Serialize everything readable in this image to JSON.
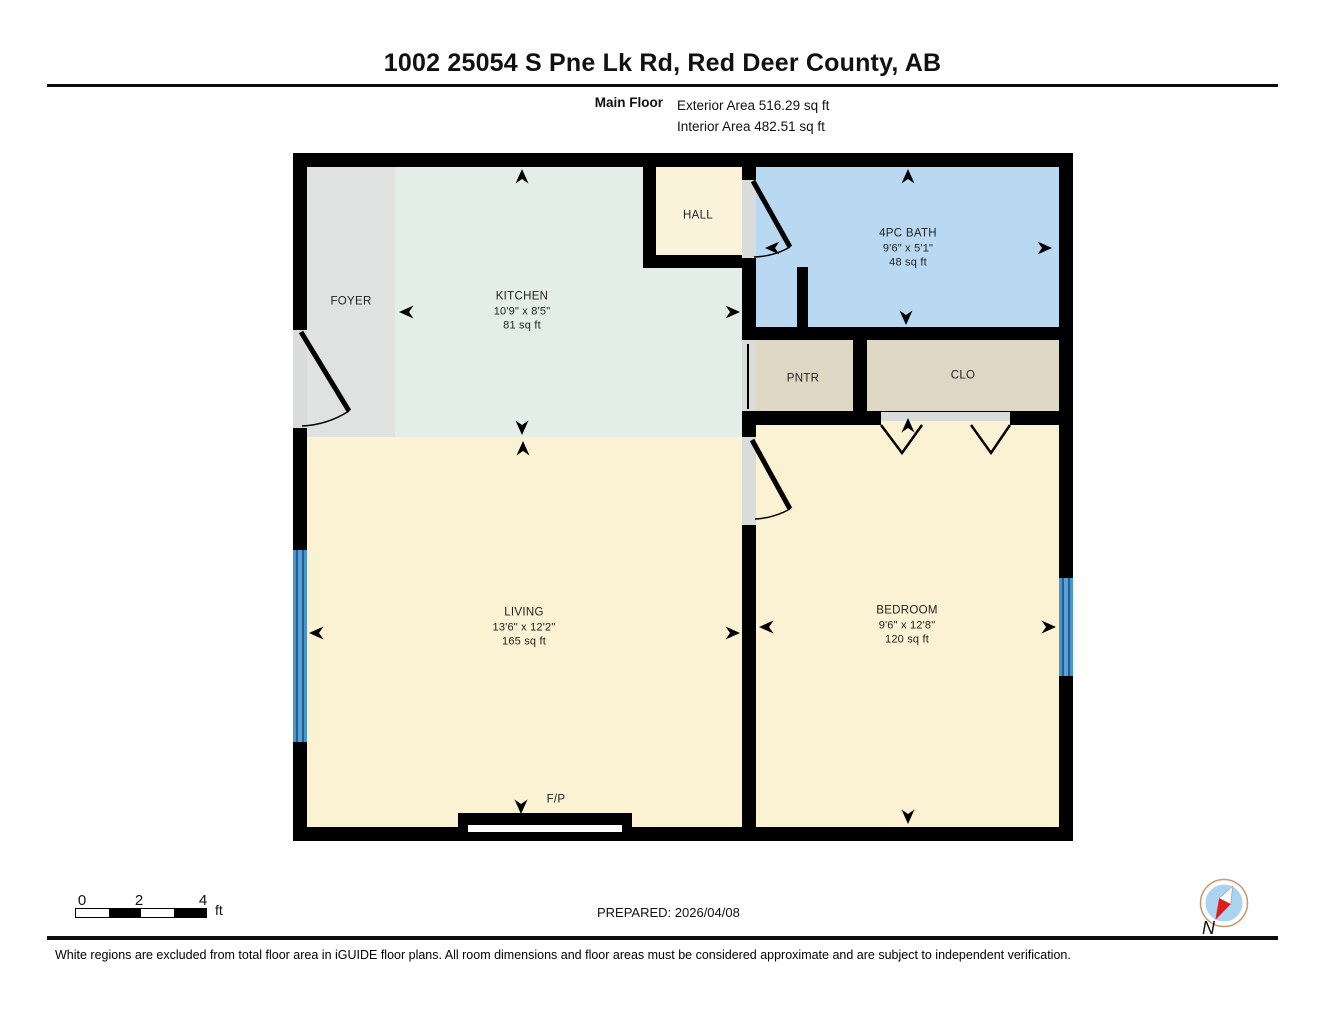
{
  "header": {
    "title": "1002 25054 S Pne Lk Rd, Red Deer County, AB",
    "floor_label": "Main Floor",
    "exterior_area": "Exterior Area 516.29 sq ft",
    "interior_area": "Interior Area 482.51 sq ft"
  },
  "rooms": {
    "foyer": {
      "name": "FOYER"
    },
    "kitchen": {
      "name": "KITCHEN",
      "dims": "10'9\" x 8'5\"",
      "area": "81 sq ft"
    },
    "hall": {
      "name": "HALL"
    },
    "bath": {
      "name": "4PC BATH",
      "dims": "9'6\" x 5'1\"",
      "area": "48 sq ft"
    },
    "pantry": {
      "name": "PNTR"
    },
    "closet": {
      "name": "CLO"
    },
    "living": {
      "name": "LIVING",
      "dims": "13'6\" x 12'2\"",
      "area": "165 sq ft"
    },
    "bedroom": {
      "name": "BEDROOM",
      "dims": "9'6\" x 12'8\"",
      "area": "120 sq ft"
    },
    "fireplace": {
      "name": "F/P"
    }
  },
  "scale_bar": {
    "ticks": [
      "0",
      "2",
      "4"
    ],
    "unit": "ft"
  },
  "footer": {
    "prepared": "PREPARED: 2026/04/08",
    "disclaimer": "White regions are excluded from total floor area in iGUIDE floor plans. All room dimensions and floor areas must be considered approximate and are subject to independent verification.",
    "compass_label": "N"
  },
  "colors": {
    "wall": "#000000",
    "foyer_floor": "#e0e2e1",
    "kitchen_floor": "#e4eee8",
    "hall_floor": "#faf3da",
    "bath_floor": "#b9d9f2",
    "pantry_closet_floor": "#ded7c4",
    "living_bedroom_floor": "#fbf2d3",
    "door_opening": "#dadcdc",
    "window_blue": "#4793cf",
    "compass_ring": "#c09a6e",
    "compass_inner": "#a9d3ef",
    "compass_needle_red": "#e01b1b"
  }
}
